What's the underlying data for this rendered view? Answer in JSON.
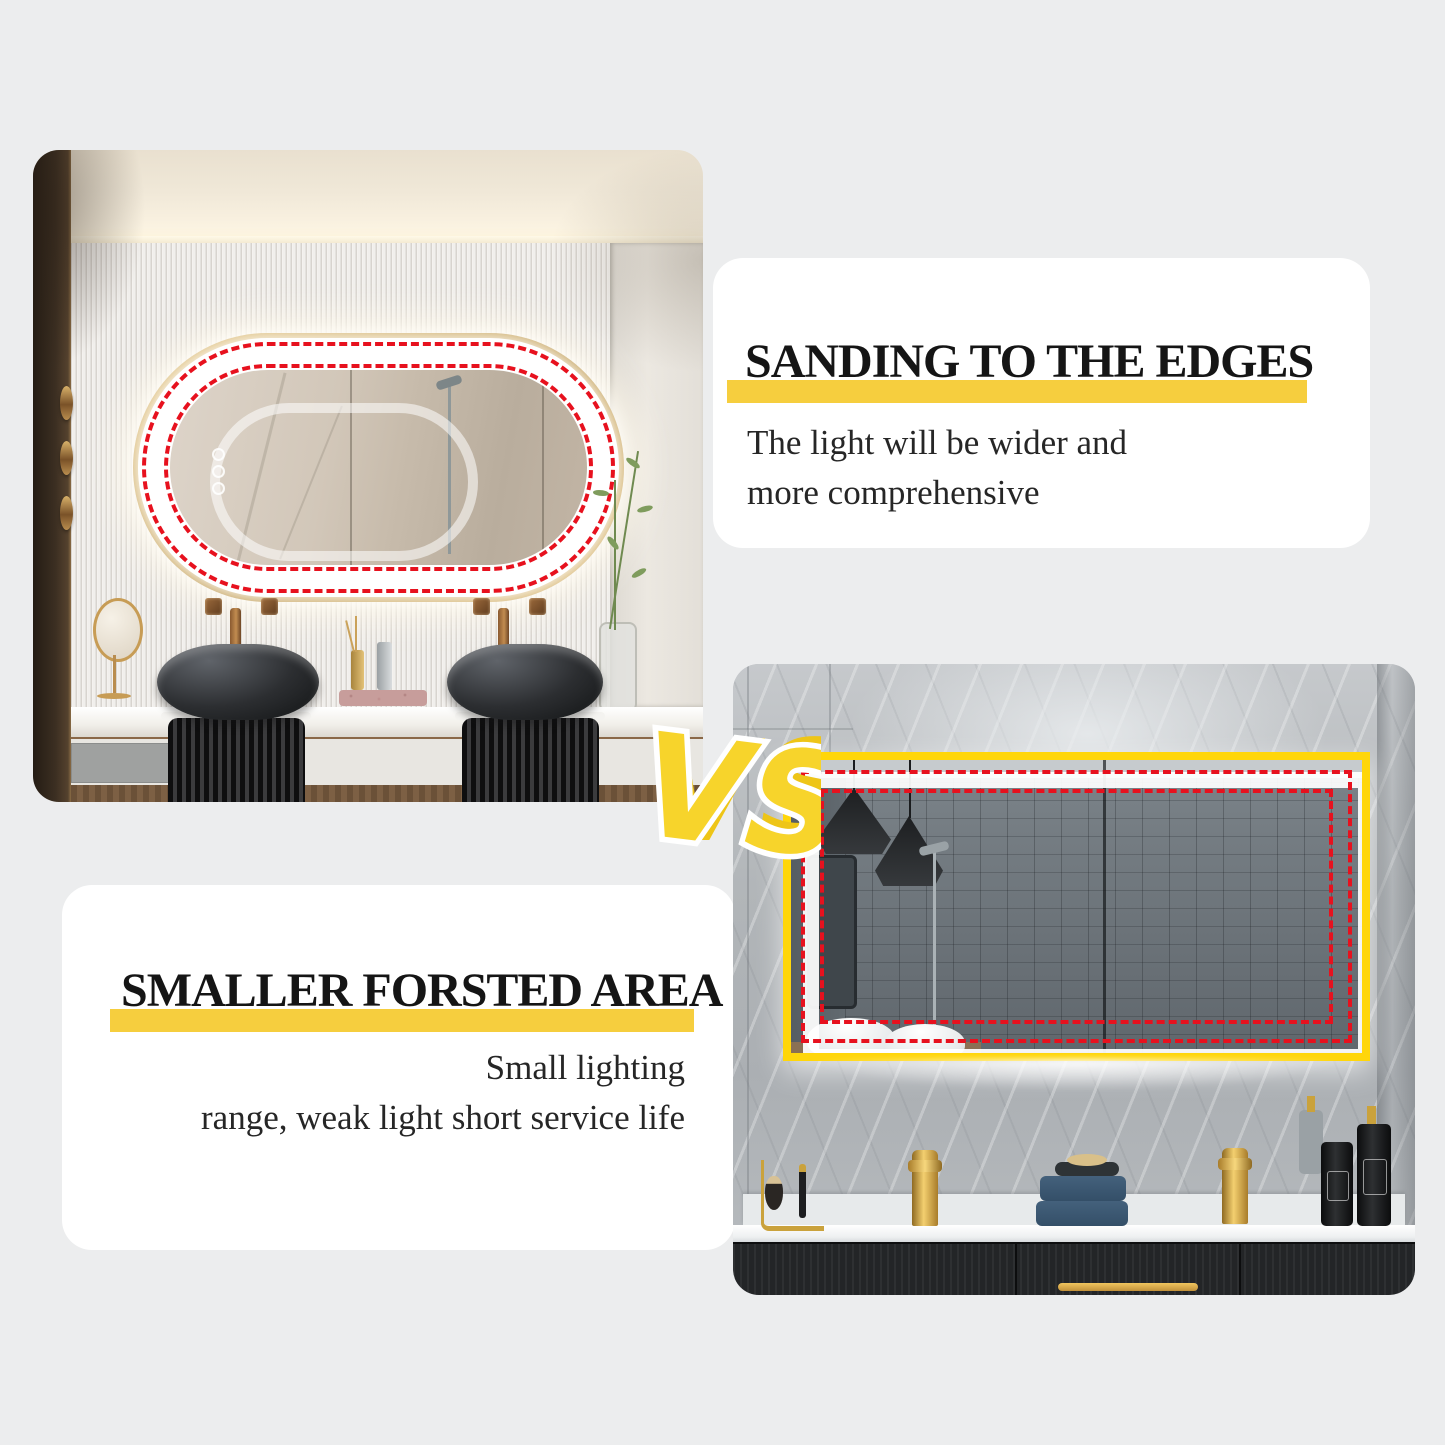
{
  "page": {
    "background_color": "#ECEDEE"
  },
  "vs_badge": {
    "label": "VS",
    "fill_color": "#F7D42B",
    "shadow_color": "#EEC517",
    "outline_color": "#FFFFFF"
  },
  "panels": {
    "sanding": {
      "heading": "SANDING TO THE EDGES",
      "line1": "The light will be wider and",
      "line2": "more comprehensive",
      "highlight_color": "#F6CE3E"
    },
    "frosted": {
      "heading": "SMALLER FORSTED AREA",
      "line1": "Small lighting",
      "line2": "range, weak light short service life",
      "highlight_color": "#F6CE3E"
    }
  },
  "annotation": {
    "dash_color": "#E7111E",
    "oval_mirror_frame_color": "#C9A24E",
    "rect_mirror_frame_color": "#FFD60A"
  }
}
